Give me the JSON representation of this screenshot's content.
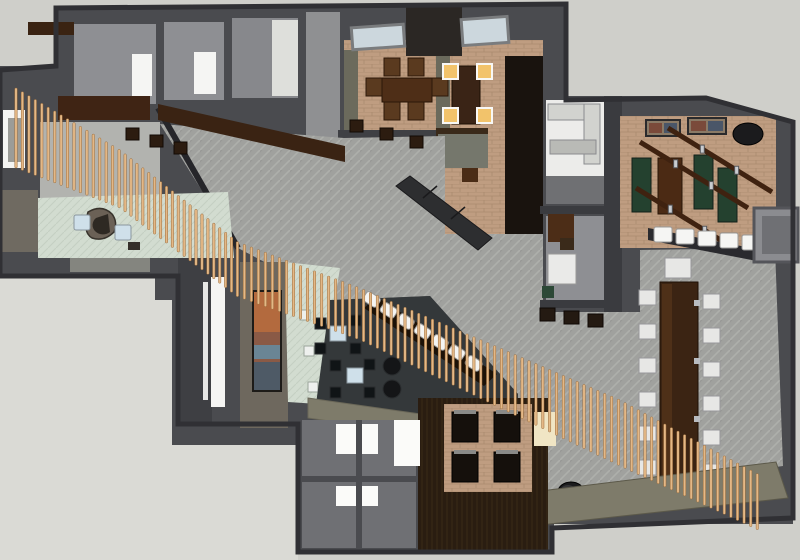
{
  "meta": {
    "type": "3d-floorplan-render",
    "style": "sketchup-style top-down axonometric rendering",
    "visible_text": "none"
  },
  "palette": {
    "bg": "#cfcfca",
    "void": "#dadad5",
    "slab": "#4a4b4f",
    "wall-dark": "#303034",
    "carpet": "#a0a19e",
    "carpet-line": "#aeafab",
    "brick": "#bf9d81",
    "brick-line": "#aa8a6e",
    "mint": "#d2dcd0",
    "taupe": "#6e685e",
    "wood-dark": "#2a1d11",
    "wood-mid": "#5a3a1f",
    "wood-table": "#3b2413",
    "beam": "#3f2210",
    "white": "#f5f5f3",
    "off-white": "#e7e7e5",
    "blue-table": "#cfe0ea",
    "green-bench": "#24412f",
    "olive": "#7e7b6a",
    "charcoal": "#2d2e30",
    "slat": "#e4b886",
    "slat-edge": "#9a6b3a",
    "amber": "#f2c36b",
    "cream": "#f0e5c4",
    "plane-light": "#b2b3af",
    "gray-floor": "#8e8f93",
    "kitchen-floor": "#ececea",
    "art-orange": "#b36a3e",
    "art-blue": "#4e5a66",
    "barrel": "#1b1b1d",
    "lounge-floor": "#34383a",
    "dark-band": "#19130e",
    "divider": "#6b6a5c",
    "sky": "#ccd7dd"
  },
  "rooms": [
    {
      "name": "storage-rooms-top-left"
    },
    {
      "name": "corridor-top"
    },
    {
      "name": "private-dining-1",
      "chairs": 6
    },
    {
      "name": "private-dining-2",
      "chairs": 4,
      "lit": true
    },
    {
      "name": "kitchen"
    },
    {
      "name": "office"
    },
    {
      "name": "game-room"
    },
    {
      "name": "main-hall"
    },
    {
      "name": "reception"
    },
    {
      "name": "art-corridor"
    },
    {
      "name": "lounge"
    },
    {
      "name": "booth-area",
      "booths": 4
    },
    {
      "name": "restrooms"
    },
    {
      "name": "communal-dining",
      "chairs": 13
    }
  ],
  "scene": {
    "slat_band": {
      "path": [
        [
          16,
          88
        ],
        [
          120,
          150
        ],
        [
          238,
          242
        ],
        [
          360,
          288
        ],
        [
          500,
          348
        ],
        [
          620,
          400
        ],
        [
          758,
          474
        ]
      ],
      "lengths": [
        80,
        58,
        55,
        52,
        60,
        66,
        56
      ],
      "spacing": 7.5,
      "width": 2.4
    },
    "communal_chairs": {
      "left_x": 639,
      "left_y": [
        290,
        324,
        358,
        392,
        426,
        460
      ],
      "right_x": 703,
      "right_y": [
        294,
        328,
        362,
        396,
        430,
        464
      ],
      "w": 17,
      "h": 15
    },
    "bar_stools": [
      [
        372,
        299
      ],
      [
        389,
        310
      ],
      [
        406,
        321
      ],
      [
        423,
        331
      ],
      [
        440,
        342
      ],
      [
        457,
        352
      ],
      [
        474,
        363
      ]
    ],
    "stool_row": [
      [
        654,
        227
      ],
      [
        676,
        229
      ],
      [
        698,
        231
      ],
      [
        720,
        233
      ],
      [
        742,
        235
      ]
    ],
    "barrels": [
      [
        495,
        486
      ],
      [
        533,
        489
      ],
      [
        571,
        492
      ],
      [
        609,
        494
      ],
      [
        649,
        496
      ],
      [
        688,
        489
      ]
    ],
    "beams": [
      [
        640,
        142,
        748,
        208
      ],
      [
        668,
        128,
        772,
        192
      ],
      [
        636,
        188,
        740,
        252
      ]
    ],
    "booth_seats": [
      [
        452,
        412
      ],
      [
        494,
        412
      ],
      [
        452,
        452
      ],
      [
        494,
        452
      ]
    ],
    "dining1_chairs": [
      [
        384,
        58
      ],
      [
        408,
        58
      ],
      [
        384,
        102
      ],
      [
        408,
        102
      ],
      [
        366,
        78
      ],
      [
        432,
        78
      ]
    ],
    "dining2_chairs": [
      [
        443,
        64
      ],
      [
        477,
        64
      ],
      [
        443,
        108
      ],
      [
        477,
        108
      ]
    ],
    "green_benches": [
      [
        632,
        158
      ],
      [
        694,
        155
      ],
      [
        718,
        168
      ]
    ],
    "picture_frames": [
      [
        646,
        120,
        34,
        16
      ],
      [
        688,
        118,
        38,
        16
      ]
    ],
    "lounge_tables": [
      [
        330,
        326
      ],
      [
        347,
        368
      ]
    ],
    "lounge_chairs": [
      [
        315,
        318
      ],
      [
        350,
        315
      ],
      [
        315,
        343
      ],
      [
        350,
        343
      ],
      [
        330,
        360
      ],
      [
        364,
        359
      ],
      [
        330,
        387
      ],
      [
        364,
        387
      ]
    ],
    "ottomans": [
      [
        392,
        366
      ],
      [
        392,
        389
      ]
    ],
    "hall_tables": [
      [
        350,
        120
      ],
      [
        380,
        128
      ],
      [
        410,
        136
      ],
      [
        126,
        128
      ],
      [
        150,
        135
      ],
      [
        174,
        142
      ]
    ],
    "office_stools": [
      [
        540,
        308
      ],
      [
        564,
        311
      ],
      [
        588,
        314
      ]
    ],
    "reception_tables": [
      [
        74,
        215
      ],
      [
        115,
        225
      ]
    ],
    "mint_side_tables": [
      [
        300,
        310
      ],
      [
        304,
        346
      ],
      [
        308,
        382
      ]
    ]
  }
}
